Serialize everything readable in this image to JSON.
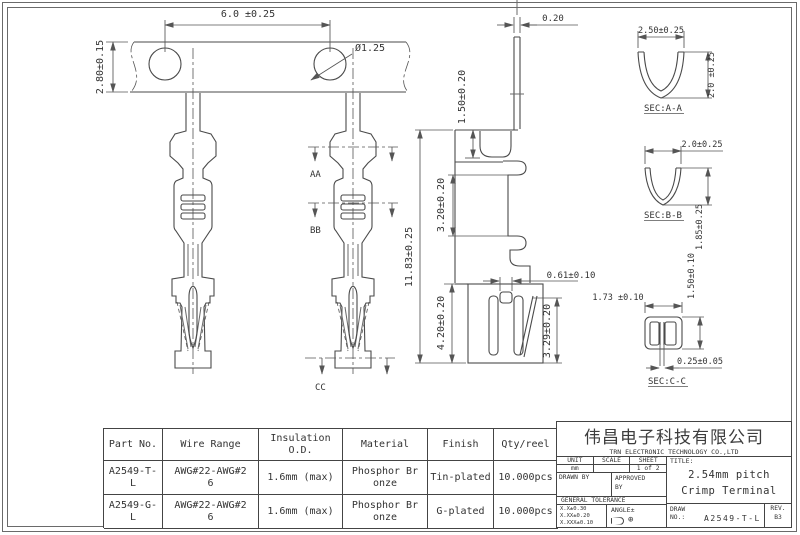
{
  "drawing": {
    "dims": {
      "pitch": "6.0 ±0.25",
      "strip_width": "2.80±0.15",
      "hole_dia": "Ø1.25",
      "thickness": "0.20",
      "tab_height": "1.50±0.20",
      "box_height": "3.20±0.20",
      "overall_length": "11.83±0.25",
      "crimp_length": "4.20±0.20",
      "slot_width": "0.61±0.10",
      "wing_height": "3.29±0.20"
    },
    "section_marks": {
      "aa": "AA",
      "bb": "BB",
      "cc": "CC"
    },
    "sections": {
      "aa": {
        "label": "SEC:A-A",
        "width": "2.50±0.25",
        "height": "2.0 ±0.25"
      },
      "bb": {
        "label": "SEC:B-B",
        "width": "2.0±0.25",
        "height": "1.85±0.25"
      },
      "cc": {
        "label": "SEC:C-C",
        "width": "1.73 ±0.10",
        "height": "1.50±0.10",
        "gap": "0.25±0.05"
      }
    },
    "colors": {
      "line": "#4a4a4a",
      "text": "#333333"
    }
  },
  "table": {
    "headers": [
      "Part No.",
      "Wire Range",
      "Insulation O.D.",
      "Material",
      "Finish",
      "Qty/reel"
    ],
    "rows": [
      [
        "A2549-T-L",
        "AWG#22-AWG#26",
        "1.6mm (max)",
        "Phosphor Bronze",
        "Tin-plated",
        "10.000pcs"
      ],
      [
        "A2549-G-L",
        "AWG#22-AWG#26",
        "1.6mm (max)",
        "Phosphor Bronze",
        "G-plated",
        "10.000pcs"
      ]
    ]
  },
  "title_block": {
    "company_cn": "伟昌电子科技有限公司",
    "company_en": "TRN ELECTRONIC TECHNOLOGY CO.,LTD",
    "unit_label": "UNIT",
    "unit_value": "mm",
    "scale_label": "SCALE",
    "scale_value": "",
    "sheet_label": "SHEET",
    "sheet_value": "1 of 2",
    "drawn_by_label": "DRAWN BY",
    "approved_by_label": "APPROVED BY",
    "general_tolerance_label": "GENERAL TOLERANCE",
    "tolerances": [
      "X.X±0.30",
      "X.XX±0.20",
      "X.XXX±0.10"
    ],
    "angle_label": "ANGLE±",
    "title_label": "TITLE:",
    "title": "2.54mm pitch Crimp Terminal",
    "draw_no_label": "DRAW NO.:",
    "draw_no": "A2549-T-L",
    "rev_label": "REV.",
    "rev": "B3"
  }
}
